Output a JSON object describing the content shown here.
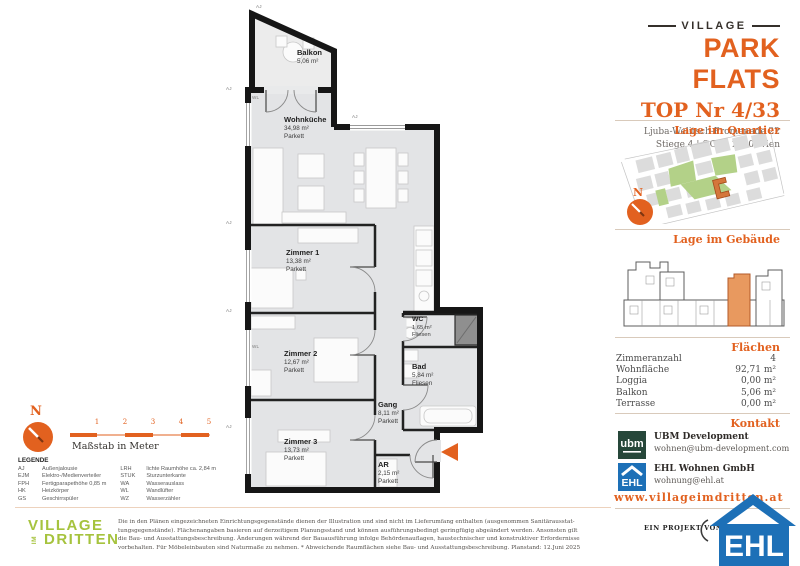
{
  "colors": {
    "accent_orange": "#e2611f",
    "village_green": "#a6c33e",
    "ehl_blue": "#1d70b7",
    "ubm_green": "#26473a",
    "map_green": "#b3d188",
    "highlight_unit": "#e8995f",
    "wall_black": "#161616",
    "floor_gray": "#e3e4e6"
  },
  "header": {
    "brand_top": "VILLAGE",
    "brand_main": "PARK FLATS",
    "unit_title": "TOP Nr 4/33",
    "address_line1": "Ljuba-Welitsch-Promenade 22",
    "address_line2": "Stiege 4 | OG 7, 1030 Wien"
  },
  "sections": {
    "quartier_title": "Lage im Quartier",
    "gebaeude_title": "Lage im Gebäude",
    "flaechen_title": "Flächen",
    "kontakt_title": "Kontakt"
  },
  "compass": {
    "label": "N"
  },
  "areas": {
    "rows": [
      {
        "label": "Zimmeranzahl",
        "value": "4"
      },
      {
        "label": "Wohnfläche",
        "value": "92,71 m²"
      },
      {
        "label": "Loggia",
        "value": "0,00 m²"
      },
      {
        "label": "Balkon",
        "value": "5,06 m²"
      },
      {
        "label": "Terrasse",
        "value": "0,00 m²"
      }
    ]
  },
  "contact": {
    "companies": [
      {
        "logo": "ubm",
        "name": "UBM Development",
        "email": "wohnen@ubm-development.com"
      },
      {
        "logo": "ehl",
        "name": "EHL Wohnen GmbH",
        "email": "wohnung@ehl.at"
      }
    ],
    "website": "www.villageimdritten.at",
    "project_by": "EIN PROJEKT VON",
    "ehl_wordmark": "EHL",
    "ubm_wordmark": "ubm"
  },
  "plan": {
    "rooms": [
      {
        "name": "Balkon",
        "area": "5,06 m²",
        "floor": ""
      },
      {
        "name": "Wohnküche",
        "area": "34,98 m²",
        "floor": "Parkett"
      },
      {
        "name": "Zimmer 1",
        "area": "13,38 m²",
        "floor": "Parkett"
      },
      {
        "name": "Zimmer 2",
        "area": "12,67 m²",
        "floor": "Parkett"
      },
      {
        "name": "Zimmer 3",
        "area": "13,73 m²",
        "floor": "Parkett"
      },
      {
        "name": "WC",
        "area": "1,65 m²",
        "floor": "Fliesen"
      },
      {
        "name": "Bad",
        "area": "5,84 m²",
        "floor": "Fliesen"
      },
      {
        "name": "Gang",
        "area": "8,11 m²",
        "floor": "Parkett"
      },
      {
        "name": "AR",
        "area": "2,15 m²",
        "floor": "Parkett"
      }
    ],
    "markers": [
      {
        "label": "AJ",
        "x": 256,
        "y": 4
      },
      {
        "label": "AJ",
        "x": 226,
        "y": 86
      },
      {
        "label": "AJ",
        "x": 226,
        "y": 220
      },
      {
        "label": "AJ",
        "x": 226,
        "y": 308
      },
      {
        "label": "AJ",
        "x": 226,
        "y": 424
      },
      {
        "label": "AJ",
        "x": 352,
        "y": 114
      },
      {
        "label": "WL",
        "x": 252,
        "y": 95
      },
      {
        "label": "WL",
        "x": 252,
        "y": 344
      }
    ]
  },
  "scalebar": {
    "ticks": [
      "1",
      "2",
      "3",
      "4",
      "5"
    ],
    "caption": "Maßstab in Meter"
  },
  "legend": {
    "title": "LEGENDE",
    "col1": [
      [
        "AJ",
        "Außenjalousie"
      ],
      [
        "EJM",
        "Elektro-/Medienverteiler"
      ],
      [
        "FPH",
        "Fertigparapethöhe 0,85 m"
      ],
      [
        "HK",
        "Heizkörper"
      ],
      [
        "GS",
        "Geschirrspüler"
      ]
    ],
    "col2": [
      [
        "LRH",
        "lichte Raumhöhe ca. 2,84 m"
      ],
      [
        "STUK",
        "Sturzunterkante"
      ],
      [
        "WA",
        "Wasserauslass"
      ],
      [
        "WL",
        "Wandlüfter"
      ],
      [
        "WZ",
        "Wasserzähler"
      ]
    ]
  },
  "footer": {
    "logo_line1": "VILLAGE",
    "logo_im": "IM",
    "logo_line2": "DRITTEN",
    "disclaimer_lines": [
      "Die in den Plänen eingezeichneten Einrichtungsgegenstände dienen der Illustration und sind nicht im Lieferumfang enthalten (ausgenommen Sanitärausstat-",
      "tungsgegenstände). Flächenangaben basieren auf derzeitigem Planungsstand und können ausführungsbedingt geringfügig abgeändert werden. Ansonsten gilt",
      "die Bau- und Ausstattungsbeschreibung. Änderungen während der Bauausführung infolge Behördenauflagen, haustechnischer und konstruktiver Erfordernisse",
      "vorbehalten. Für Möbeleinbauten sind Naturmaße zu nehmen. * Abweichende Raumflächen siehe Bau- und Ausstattungsbeschreibung. Planstand: 12.Juni 2025"
    ]
  }
}
